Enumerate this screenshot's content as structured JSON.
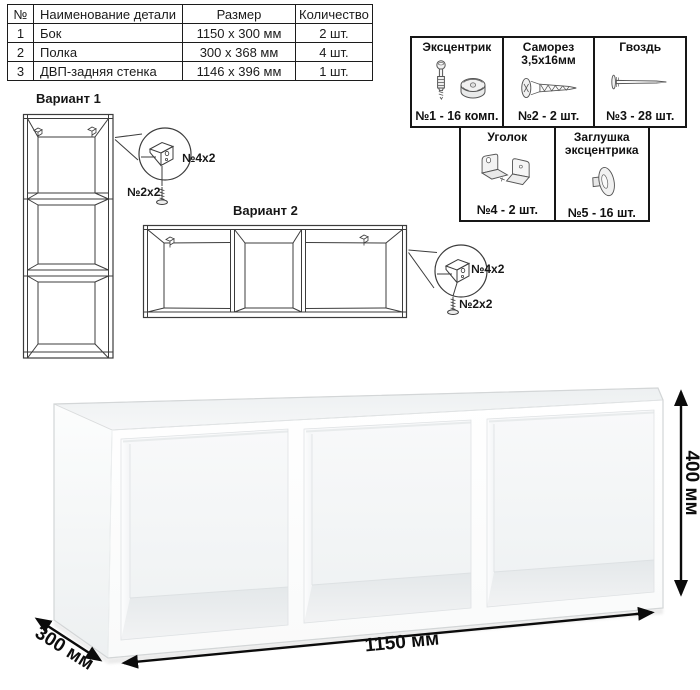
{
  "parts_table": {
    "headers": [
      "№",
      "Наименование детали",
      "Размер",
      "Количество"
    ],
    "rows": [
      {
        "num": "1",
        "name": "Бок",
        "size": "1150 х 300 мм",
        "qty": "2 шт."
      },
      {
        "num": "2",
        "name": "Полка",
        "size": "300 х 368 мм",
        "qty": "4 шт."
      },
      {
        "num": "3",
        "name": "ДВП-задняя стенка",
        "size": "1146 х 396 мм",
        "qty": "1 шт."
      }
    ]
  },
  "hardware": {
    "items": [
      {
        "name": "Эксцентрик",
        "icon": "eccentric-icon",
        "count": "№1 - 16 комп."
      },
      {
        "name": "Саморез 3,5х16мм",
        "icon": "screw-icon",
        "count": "№2 - 2 шт."
      },
      {
        "name": "Гвоздь",
        "icon": "nail-icon",
        "count": "№3 - 28 шт."
      },
      {
        "name": "Уголок",
        "icon": "corner-bracket-icon",
        "count": "№4 - 2 шт."
      },
      {
        "name": "Заглушка эксцентрика",
        "icon": "cam-cover-icon",
        "count": "№5 - 16 шт."
      }
    ]
  },
  "variants": {
    "v1": {
      "title": "Вариант 1",
      "bracket_label": "№4х2",
      "screw_label": "№2х2"
    },
    "v2": {
      "title": "Вариант 2",
      "bracket_label": "№4х2",
      "screw_label": "№2х2"
    }
  },
  "dimensions": {
    "width": "1150 мм",
    "height": "400 мм",
    "depth": "300 мм"
  },
  "colors": {
    "line": "#1c1c1c",
    "drawing_line": "#3c3c3c",
    "dimension": "#0d0d0d",
    "render_edge": "#d3d6d7",
    "render_shadow": "#e8e8e8"
  }
}
